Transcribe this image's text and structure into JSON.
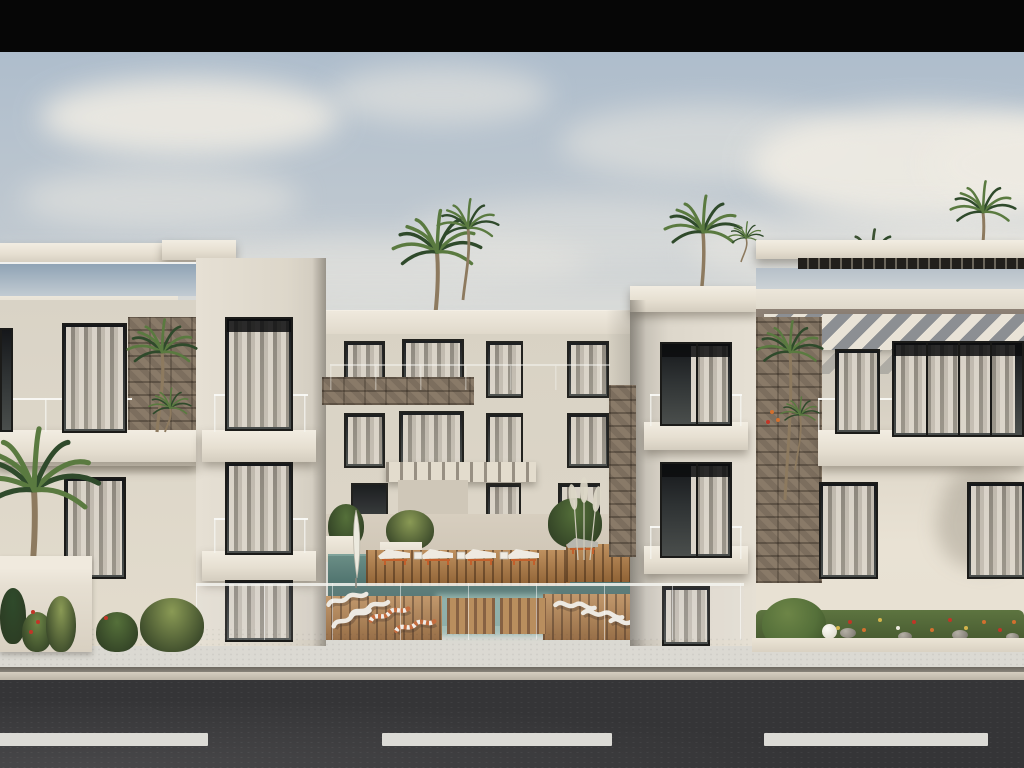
{
  "meta": {
    "description": "Architectural 3D exterior rendering of a modern white three-storey apartment complex with a central courtyard swimming pool, wooden sun decks, orange-and-white sun loungers, rooftop pergolas, stone accent walls, palm trees, flower beds, a beige sidewalk and an asphalt road with white dashed lane markings in the foreground, under a hazy blue sky with clouds. A solid black letterbox bar runs across the top of the frame."
  },
  "colors": {
    "bar": "#060606",
    "skyTop": "#aebdcc",
    "skyHorizon": "#dcdad3",
    "cloud": "#eeebe3",
    "wall": "#ddd7cb",
    "wallBright": "#e9e2d4",
    "wallShadow": "#b7b2a8",
    "slab": "#ece6da",
    "stone": "#7c6e5e",
    "windowFrame": "#1b1b19",
    "windowGlass": "#2e3233",
    "curtain": "#e0d8c9",
    "awningShadow": "#8c8f93",
    "pergolaSlat": "#221f1b",
    "fasciaShadow": "#8d8175",
    "poolDeep": "#41625f",
    "pool": "#527671",
    "poolShallow": "#93b7ae",
    "deckWood": "#a9743f",
    "stoolWood": "#b5854f",
    "cushion": "#efeae1",
    "cushionGrey": "#b8b6ae",
    "loungerOrange": "#c2602c",
    "sidewalk": "#ded6c7",
    "curb": "#6b675f",
    "road": "#353537",
    "dash": "#dcdbd6",
    "palmDark": "#2f4a2b",
    "palmLight": "#5a7a40",
    "trunk": "#8d7a5f",
    "bush": "#55703a",
    "grass": "#8a9a55",
    "agave": "#6f8747",
    "fRed": "#c23527",
    "fOrange": "#d2702f",
    "fYellow": "#d3b44c",
    "fWhite": "#eceade",
    "pampas": "#ddd8c8",
    "umbrella": "#eceadf"
  },
  "scene": {
    "black_bar": {
      "height": 52
    },
    "clouds": [
      {
        "x": 40,
        "y": 78,
        "w": 300,
        "h": 78,
        "o": 0.9
      },
      {
        "x": 330,
        "y": 66,
        "w": 220,
        "h": 58,
        "o": 0.55
      },
      {
        "x": 560,
        "y": 104,
        "w": 300,
        "h": 78,
        "o": 0.5
      },
      {
        "x": 750,
        "y": 108,
        "w": 350,
        "h": 112,
        "o": 0.95
      },
      {
        "x": 930,
        "y": 118,
        "w": 230,
        "h": 92,
        "o": 0.9
      },
      {
        "x": 20,
        "y": 168,
        "w": 280,
        "h": 62,
        "o": 0.5
      },
      {
        "x": 410,
        "y": 196,
        "w": 360,
        "h": 70,
        "o": 0.42
      },
      {
        "x": 690,
        "y": 210,
        "w": 430,
        "h": 82,
        "o": 0.55
      },
      {
        "x": 160,
        "y": 232,
        "w": 430,
        "h": 62,
        "o": 0.45
      },
      {
        "x": 860,
        "y": 226,
        "w": 310,
        "h": 72,
        "o": 0.6
      }
    ],
    "windows_back": [
      {
        "x": 344,
        "y": 341,
        "w": 41,
        "h": 57,
        "cs": 1
      },
      {
        "x": 402,
        "y": 339,
        "w": 62,
        "h": 60,
        "cs": 1
      },
      {
        "x": 486,
        "y": 341,
        "w": 37,
        "h": 57,
        "cs": 1
      },
      {
        "x": 567,
        "y": 341,
        "w": 42,
        "h": 57,
        "cs": 1
      },
      {
        "x": 344,
        "y": 413,
        "w": 41,
        "h": 55,
        "cs": 1
      },
      {
        "x": 399,
        "y": 411,
        "w": 65,
        "h": 58,
        "cs": 1
      },
      {
        "x": 486,
        "y": 413,
        "w": 37,
        "h": 55,
        "cs": 1
      },
      {
        "x": 567,
        "y": 413,
        "w": 42,
        "h": 55,
        "cs": 1
      },
      {
        "x": 351,
        "y": 483,
        "w": 37,
        "h": 62,
        "cs": 0
      },
      {
        "x": 403,
        "y": 481,
        "w": 60,
        "h": 66,
        "cs": 1
      },
      {
        "x": 486,
        "y": 483,
        "w": 35,
        "h": 61,
        "cs": 1
      },
      {
        "x": 558,
        "y": 483,
        "w": 42,
        "h": 61,
        "cs": 1
      }
    ],
    "windows_front": [
      {
        "x": 0,
        "y": 328,
        "w": 13,
        "h": 104,
        "cs": 0
      },
      {
        "x": 62,
        "y": 323,
        "w": 65,
        "h": 110,
        "cs": 1
      },
      {
        "x": 225,
        "y": 317,
        "w": 68,
        "h": 114,
        "cs": 1,
        "tb": 1
      },
      {
        "x": 64,
        "y": 477,
        "w": 62,
        "h": 102,
        "cs": 1
      },
      {
        "x": 225,
        "y": 462,
        "w": 68,
        "h": 93,
        "cs": 1
      },
      {
        "x": 225,
        "y": 580,
        "w": 68,
        "h": 62,
        "cs": 1
      },
      {
        "x": 660,
        "y": 342,
        "w": 72,
        "h": 84,
        "cs": 2,
        "m": 1,
        "tb": 1
      },
      {
        "x": 660,
        "y": 462,
        "w": 72,
        "h": 96,
        "cs": 2,
        "m": 1,
        "tb": 1
      },
      {
        "x": 662,
        "y": 586,
        "w": 48,
        "h": 60,
        "cs": 1
      },
      {
        "x": 835,
        "y": 349,
        "w": 45,
        "h": 85,
        "cs": 1
      },
      {
        "x": 892,
        "y": 341,
        "w": 132,
        "h": 96,
        "cs": 1,
        "m": 3,
        "tb": 1
      },
      {
        "x": 819,
        "y": 482,
        "w": 59,
        "h": 97,
        "cs": 1
      },
      {
        "x": 967,
        "y": 482,
        "w": 59,
        "h": 97,
        "cs": 1
      }
    ],
    "slabs": [
      {
        "x": 0,
        "y": 430,
        "w": 196,
        "h": 36
      },
      {
        "x": 202,
        "y": 430,
        "w": 114,
        "h": 32
      },
      {
        "x": 202,
        "y": 551,
        "w": 114,
        "h": 30
      },
      {
        "x": 644,
        "y": 422,
        "w": 104,
        "h": 28
      },
      {
        "x": 644,
        "y": 546,
        "w": 104,
        "h": 28
      },
      {
        "x": 818,
        "y": 430,
        "w": 206,
        "h": 36
      }
    ],
    "rails": [
      {
        "x": 0,
        "y": 398,
        "w": 132,
        "h": 34
      },
      {
        "x": 214,
        "y": 394,
        "w": 94,
        "h": 38
      },
      {
        "x": 214,
        "y": 518,
        "w": 94,
        "h": 35
      },
      {
        "x": 650,
        "y": 394,
        "w": 92,
        "h": 32
      },
      {
        "x": 650,
        "y": 526,
        "w": 92,
        "h": 33
      },
      {
        "x": 818,
        "y": 398,
        "w": 206,
        "h": 34
      },
      {
        "x": 330,
        "y": 364,
        "w": 280,
        "h": 26,
        "o": 0.5
      }
    ],
    "stones": [
      {
        "x": 128,
        "y": 317,
        "w": 68,
        "h": 118
      },
      {
        "x": 322,
        "y": 377,
        "w": 152,
        "h": 28
      },
      {
        "x": 609,
        "y": 385,
        "w": 27,
        "h": 172
      },
      {
        "x": 756,
        "y": 317,
        "w": 66,
        "h": 266
      }
    ],
    "palms_back": [
      {
        "x": 437,
        "y": 252,
        "s": 1.15,
        "g": 352
      },
      {
        "x": 468,
        "y": 228,
        "s": 0.8,
        "g": 300
      },
      {
        "x": 703,
        "y": 232,
        "s": 1.0,
        "g": 328
      },
      {
        "x": 983,
        "y": 212,
        "s": 0.85,
        "g": 282
      },
      {
        "x": 872,
        "y": 262,
        "s": 0.9,
        "g": 322,
        "dark": 1
      },
      {
        "x": 746,
        "y": 238,
        "s": 0.45,
        "g": 262
      }
    ],
    "palms_front": [
      {
        "x": 34,
        "y": 490,
        "s": 1.7,
        "g": 618
      },
      {
        "x": 162,
        "y": 352,
        "s": 0.9,
        "g": 432
      },
      {
        "x": 170,
        "y": 408,
        "s": 0.55,
        "g": 432
      },
      {
        "x": 790,
        "y": 352,
        "s": 0.85,
        "g": 500
      },
      {
        "x": 800,
        "y": 415,
        "s": 0.5,
        "g": 470
      }
    ],
    "courtyard": {
      "plants": [
        {
          "x": 328,
          "y": 504,
          "w": 36,
          "h": 44,
          "c": "bush"
        },
        {
          "x": 386,
          "y": 510,
          "w": 48,
          "h": 40,
          "c": "grass"
        },
        {
          "x": 548,
          "y": 498,
          "w": 54,
          "h": 50,
          "c": "bush"
        },
        {
          "x": 624,
          "y": 514,
          "w": 22,
          "h": 32,
          "c": "agave"
        }
      ],
      "planter_boxes": [
        {
          "x": 324,
          "y": 536,
          "w": 32,
          "h": 24
        },
        {
          "x": 380,
          "y": 542,
          "w": 42,
          "h": 18
        }
      ],
      "stools": [
        {
          "x": 447,
          "y": 598,
          "w": 48,
          "h": 36
        },
        {
          "x": 500,
          "y": 598,
          "w": 46,
          "h": 36
        }
      ],
      "loungers": [
        {
          "t": "flat",
          "x": 378,
          "y": 549,
          "r": 0
        },
        {
          "t": "flat",
          "x": 421,
          "y": 549,
          "r": 0
        },
        {
          "t": "flat",
          "x": 464,
          "y": 549,
          "r": 0
        },
        {
          "t": "flat",
          "x": 507,
          "y": 549,
          "r": 0
        },
        {
          "t": "table",
          "x": 414,
          "y": 552,
          "r": 0
        },
        {
          "t": "table",
          "x": 457,
          "y": 552,
          "r": 0
        },
        {
          "t": "table",
          "x": 500,
          "y": 552,
          "r": 0
        },
        {
          "t": "flatgrey",
          "x": 566,
          "y": 538,
          "r": 0
        },
        {
          "t": "flatgrey",
          "x": 610,
          "y": 538,
          "r": 0
        },
        {
          "t": "wavy",
          "x": 326,
          "y": 596,
          "r": -10
        },
        {
          "t": "wavy",
          "x": 348,
          "y": 607,
          "r": -14
        },
        {
          "t": "wavy",
          "x": 330,
          "y": 618,
          "r": -18
        },
        {
          "t": "striped",
          "x": 368,
          "y": 612,
          "r": -12
        },
        {
          "t": "striped",
          "x": 394,
          "y": 622,
          "r": -8
        },
        {
          "t": "wavy",
          "x": 556,
          "y": 596,
          "r": 10
        },
        {
          "t": "wavy",
          "x": 584,
          "y": 604,
          "r": 12
        },
        {
          "t": "wavy",
          "x": 612,
          "y": 612,
          "r": 14
        },
        {
          "t": "wavy",
          "x": 638,
          "y": 620,
          "r": 16
        }
      ]
    },
    "left_planter_plants": [
      {
        "x": 0,
        "y": 588,
        "w": 26,
        "h": 56,
        "c": "palmDark"
      },
      {
        "x": 22,
        "y": 612,
        "w": 30,
        "h": 40,
        "c": "agave"
      },
      {
        "x": 46,
        "y": 596,
        "w": 30,
        "h": 56,
        "c": "grass"
      },
      {
        "x": 96,
        "y": 612,
        "w": 42,
        "h": 40,
        "c": "bush"
      },
      {
        "x": 140,
        "y": 598,
        "w": 64,
        "h": 54,
        "c": "grass"
      }
    ],
    "left_flowers": [
      {
        "x": 31,
        "y": 610,
        "c": "fRed"
      },
      {
        "x": 36,
        "y": 620,
        "c": "fRed"
      },
      {
        "x": 29,
        "y": 630,
        "c": "fRed"
      },
      {
        "x": 104,
        "y": 616,
        "c": "fRed"
      }
    ],
    "bed_flowers": [
      {
        "x": 848,
        "y": 620,
        "c": "fRed"
      },
      {
        "x": 862,
        "y": 628,
        "c": "fOrange"
      },
      {
        "x": 878,
        "y": 618,
        "c": "fYellow"
      },
      {
        "x": 896,
        "y": 626,
        "c": "fWhite"
      },
      {
        "x": 912,
        "y": 620,
        "c": "fRed"
      },
      {
        "x": 930,
        "y": 628,
        "c": "fOrange"
      },
      {
        "x": 948,
        "y": 618,
        "c": "fRed"
      },
      {
        "x": 964,
        "y": 626,
        "c": "fYellow"
      },
      {
        "x": 982,
        "y": 620,
        "c": "fOrange"
      },
      {
        "x": 998,
        "y": 628,
        "c": "fRed"
      },
      {
        "x": 1012,
        "y": 620,
        "c": "fOrange"
      },
      {
        "x": 836,
        "y": 626,
        "c": "fYellow"
      },
      {
        "x": 770,
        "y": 410,
        "c": "fOrange"
      },
      {
        "x": 776,
        "y": 418,
        "c": "fOrange"
      },
      {
        "x": 766,
        "y": 420,
        "c": "fRed"
      }
    ],
    "bed_rocks": [
      {
        "x": 840,
        "y": 628,
        "w": 16,
        "h": 10
      },
      {
        "x": 898,
        "y": 632,
        "w": 14,
        "h": 9
      },
      {
        "x": 952,
        "y": 630,
        "w": 16,
        "h": 10
      },
      {
        "x": 1006,
        "y": 633,
        "w": 13,
        "h": 8
      }
    ],
    "road": {
      "dash_y": 733,
      "dash_h": 13,
      "dashes": [
        {
          "x": -10,
          "w": 218
        },
        {
          "x": 382,
          "w": 230
        },
        {
          "x": 764,
          "w": 224
        }
      ]
    }
  }
}
